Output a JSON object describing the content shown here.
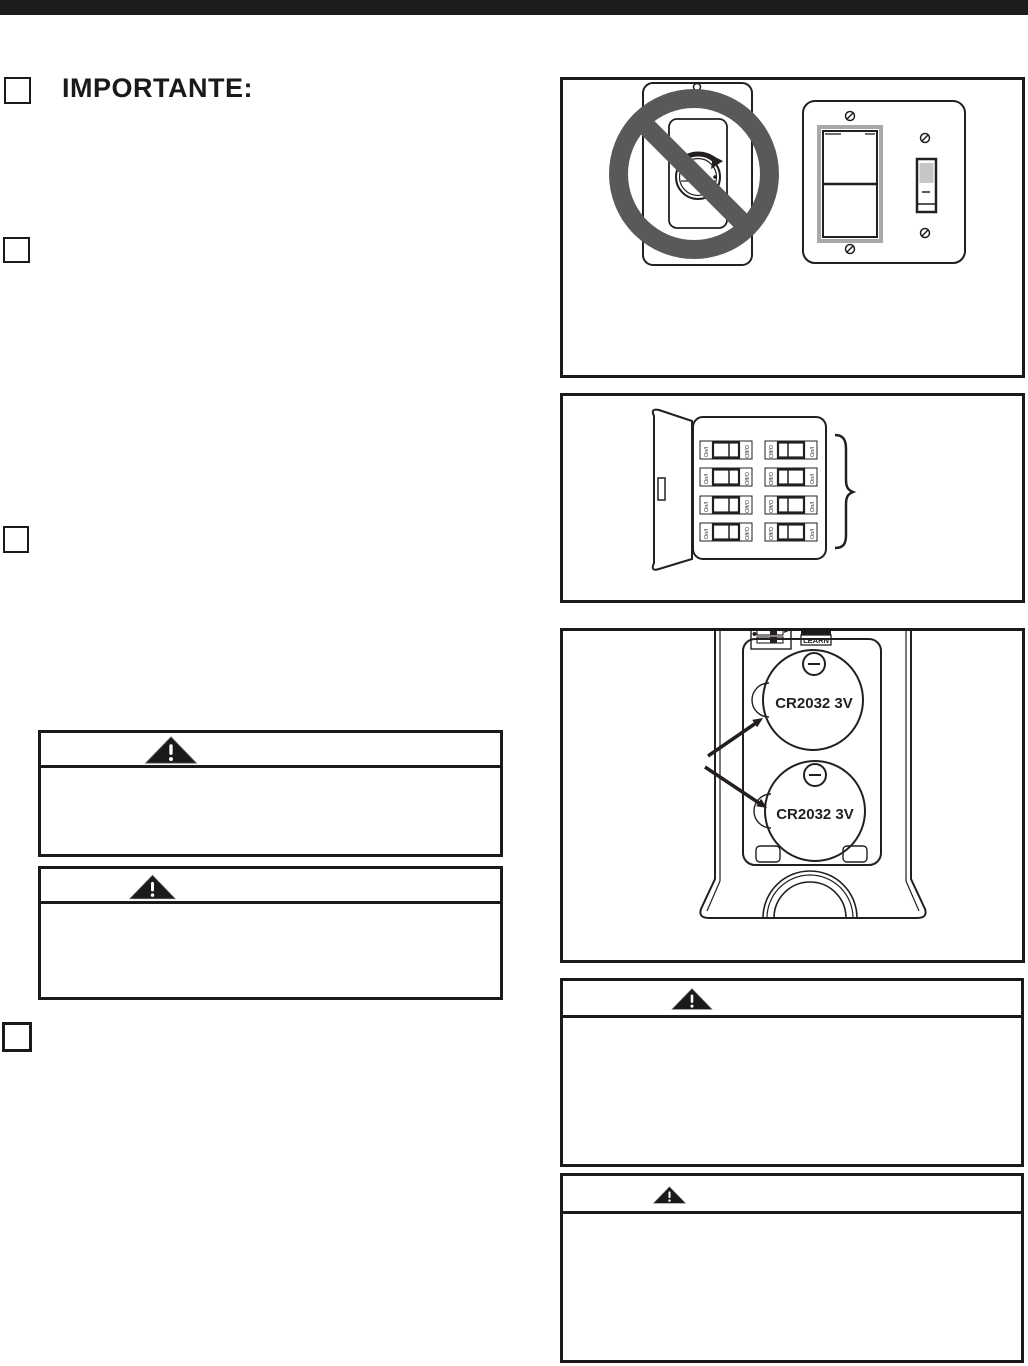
{
  "page": {
    "heading": "IMPORTANTE:"
  },
  "colors": {
    "ink": "#231f20",
    "top_bar": "#1c1c1c",
    "prohibition_gray": "#58595b",
    "toggle_handle_gray": "#c6c6c6",
    "warning_triangle_fill": "#1a1a1a"
  },
  "checkboxes": {
    "count": 4,
    "checked": false
  },
  "figures": {
    "no_dimmer": {
      "description": "dimmer-control-prohibited-and-wall-switches"
    },
    "breaker_panel": {
      "on_label": "On/I",
      "off_label": "Off/O",
      "breaker_count": 8
    },
    "remote": {
      "learn_label": "LEARN",
      "battery_label": "CR2032 3V",
      "battery_count": 2
    }
  },
  "warnings": {
    "count": 4,
    "icon": "warning-triangle"
  }
}
